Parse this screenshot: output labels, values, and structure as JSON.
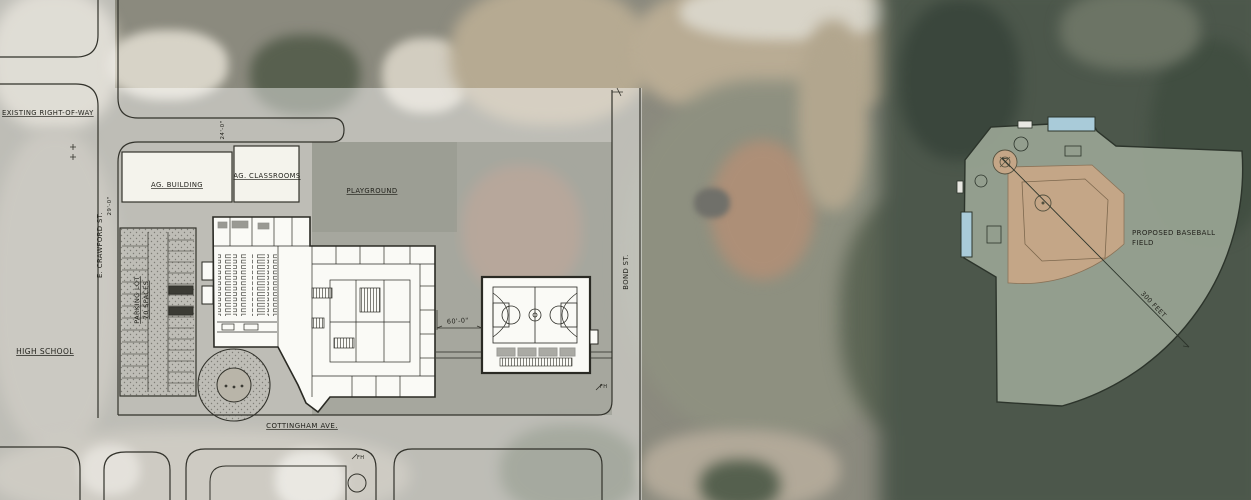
{
  "document": {
    "kind": "school campus site plan over aerial photograph"
  },
  "labels": {
    "existing_right_of_way": "EXISTING RIGHT-OF-WAY",
    "ag_building": "AG. BUILDING",
    "ag_classrooms": "AG. CLASSROOMS",
    "playground": "PLAYGROUND",
    "crawford_st": "E. CRAWFORD ST.",
    "parking_lot_line1": "PARKING LOT",
    "parking_lot_line2": "70 SPACES",
    "high_school": "HIGH SCHOOL",
    "cottingham_ave": "COTTINGHAM AVE.",
    "bond_st": "BOND ST.",
    "proposed_baseball_line1": "PROPOSED BASEBALL",
    "proposed_baseball_line2": "FIELD",
    "distance_marker": "300 FEET",
    "dim_building_gap": "60'-0\"",
    "dim_drive_width": "24'-0\"",
    "dim_street_width": "29'-0\"",
    "fire_hydrant_1": "FH",
    "fire_hydrant_2": "FH"
  },
  "colors": {
    "plan_overlay_white": "rgba(255,255,255,0.44)",
    "ballfield_green": "#97a291",
    "infield_tan": "#c4a687",
    "bleacher_blue": "#a9cbd9",
    "building_white": "#fafaf6",
    "linework": "#32322b",
    "aerial_trees": "#4c574b",
    "aerial_dirt": "#b9ac94"
  }
}
